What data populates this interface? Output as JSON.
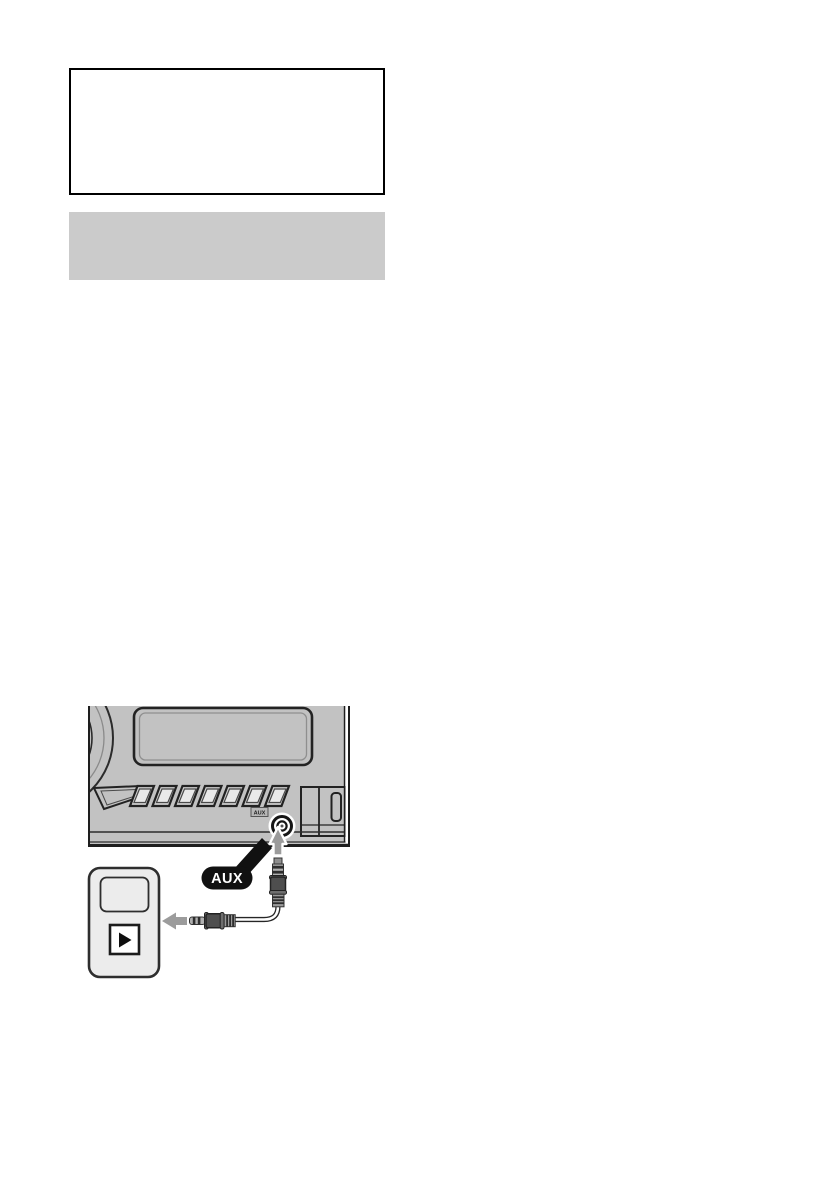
{
  "page": {
    "width_px": 840,
    "height_px": 1190,
    "background": "#ffffff"
  },
  "placeholder_boxes": {
    "outlined_box": {
      "border_color": "#000000",
      "fill": "#ffffff"
    },
    "gray_box": {
      "fill": "#cbcbcb"
    }
  },
  "diagram": {
    "aux_callout": {
      "label": "AUX",
      "bg": "#111111",
      "text_color": "#ffffff"
    },
    "aux_jack_label": {
      "label": "AUX"
    },
    "icons": {
      "play_icon": "▶",
      "up_arrow_icon": "↑",
      "left_arrow_icon": "←"
    },
    "colors": {
      "unit_body": "#c2c2c2",
      "dark_outline": "#222222",
      "arrow_gray": "#9c9c9c",
      "plug_body": "#4e4e4e",
      "plug_metal": "#b0b0b0",
      "device_body": "#ececec",
      "callout_black": "#111111"
    }
  }
}
